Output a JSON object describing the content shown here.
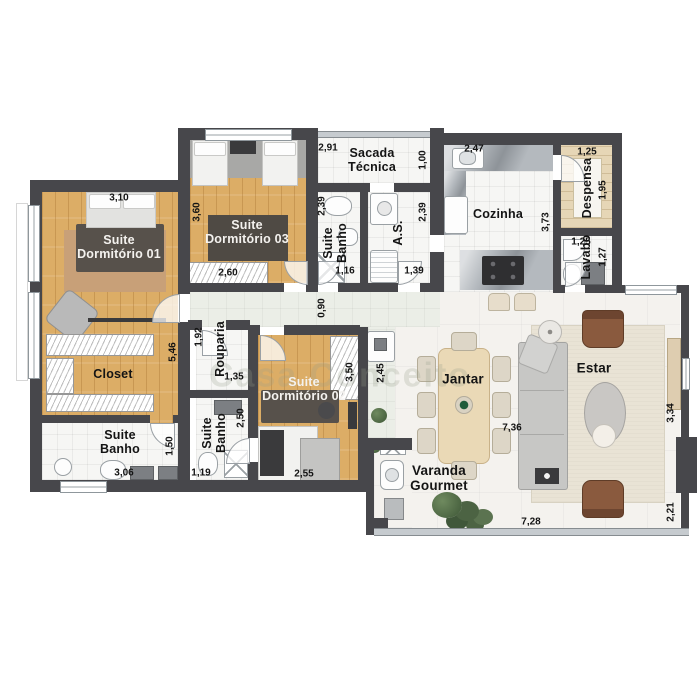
{
  "watermark": "Casa Conceito",
  "rooms": {
    "suite01": "Suite\nDormitório 01",
    "closet": "Closet",
    "banho01": "Suite\nBanho",
    "suite03": "Suite\nDormitório 03",
    "banho03": "Suite\nBanho",
    "as": "A.S.",
    "sacada": "Sacada\nTécnica",
    "cozinha": "Cozinha",
    "despensa": "Despensa",
    "lavabo": "Lavabo",
    "rouparia": "Rouparia",
    "banho02": "Suite\nBanho",
    "suite02": "Suite\nDormitório 02",
    "jantar": "Jantar",
    "estar": "Estar",
    "varanda": "Varanda\nGourmet"
  },
  "dimensions": {
    "suite01_width": "3,10",
    "suite01_height": "5,46",
    "banho01_height": "1,50",
    "banho01_width": "3,06",
    "suite03_height": "3,60",
    "suite03_wardrobe": "2,60",
    "sacada_width": "2,91",
    "sacada_height": "1,00",
    "banho03_height": "2,39",
    "banho03_width": "1,16",
    "as_height": "2,39",
    "as_width": "1,39",
    "cozinha_width": "2,47",
    "cozinha_height": "3,73",
    "despensa_width": "1,25",
    "despensa_height": "1,95",
    "lavabo_width": "1,25",
    "lavabo_height": "1,27",
    "hall_width": "0,90",
    "rouparia_height": "1,92",
    "rouparia_width": "1,35",
    "banho02_height": "2,50",
    "banho02_width": "1,19",
    "suite02_height": "3,50",
    "suite02_width": "2,55",
    "corridor_height": "2,45",
    "living_width": "7,36",
    "varanda_width": "7,28",
    "estar_height": "3,34",
    "varanda_height": "2,21"
  }
}
